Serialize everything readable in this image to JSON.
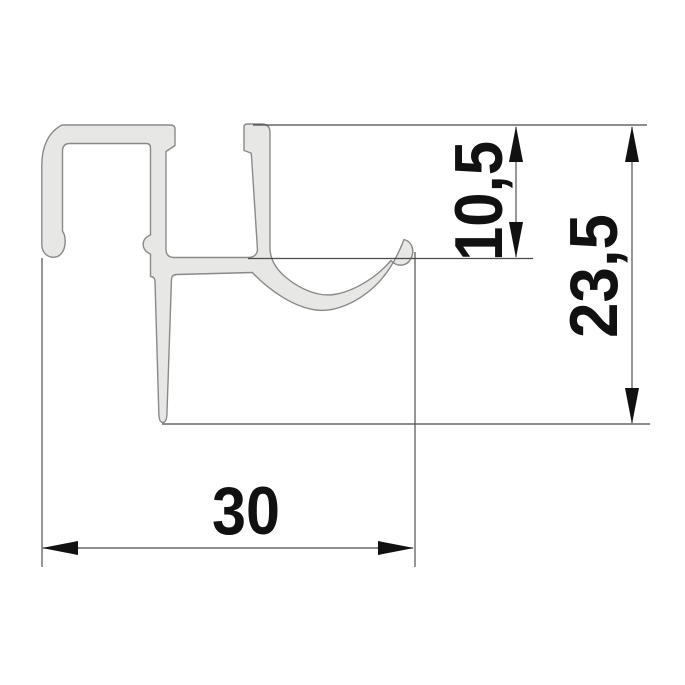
{
  "drawing": {
    "background_color": "#ffffff",
    "profile": {
      "fill_color": "#e7e8e6",
      "outline_color": "#878b86"
    },
    "dimension_style": {
      "line_color": "#4a4a4a",
      "arrow_and_text_color": "#111111"
    },
    "dimensions": {
      "width": {
        "label": "30",
        "value": 30
      },
      "upper_height": {
        "label": "10,5",
        "value": 10.5
      },
      "total_height": {
        "label": "23,5",
        "value": 23.5
      }
    }
  }
}
